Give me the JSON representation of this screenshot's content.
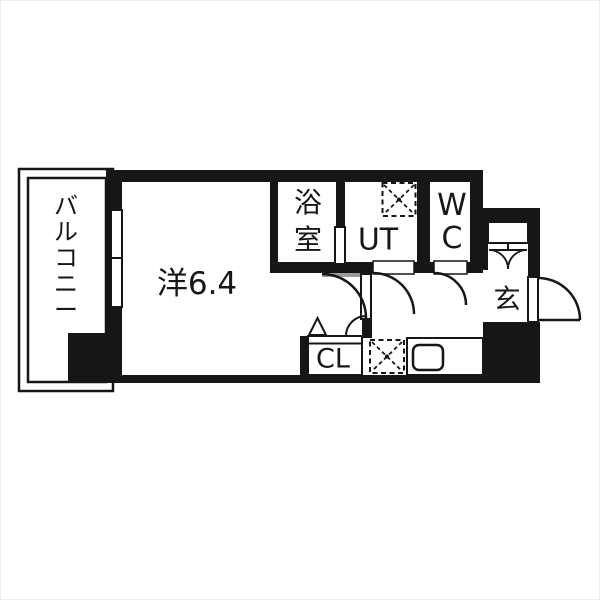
{
  "colors": {
    "wall": "#161616",
    "line": "#161616",
    "door_threshold": "#9a9a9a",
    "background": "#ffffff"
  },
  "rooms": {
    "balcony": {
      "label": "バルコニー"
    },
    "main_room": {
      "label": "洋6.4"
    },
    "bathroom": {
      "label": "浴室"
    },
    "utility": {
      "label": "UT"
    },
    "toilet": {
      "label": "WC"
    },
    "entrance": {
      "label": "玄"
    },
    "closet": {
      "label": "CL"
    }
  },
  "fixtures": {
    "washing_machine_pan": "dashed-square-x",
    "refrigerator_space": "dashed-square-x",
    "kitchen_sink": "rounded-rect-sink",
    "kitchen_counter": "counter-outline",
    "shoe_cabinet": "double-swing-cabinet",
    "entrance_door": "swing-door",
    "interior_doors": "swing-doors",
    "closet_door": "folding-door",
    "balcony_window": "sliding-glass-door"
  }
}
